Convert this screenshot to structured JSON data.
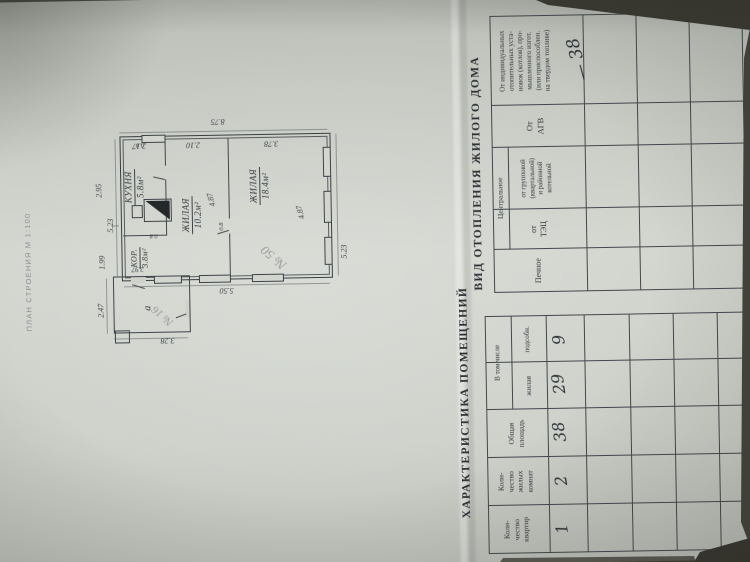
{
  "photo": {
    "page_color": "#cdd0c9",
    "background_color": "#46453d",
    "ink_color": "#373e42",
    "pencil_color": "#979e9e"
  },
  "plan": {
    "caption": "ПЛАН СТРОЕНИЯ  М 1:100",
    "rooms": {
      "kitchen": {
        "name": "КУХНЯ",
        "area": "5.8м²"
      },
      "corridor": {
        "name": "КОР.",
        "area": "3.8м²"
      },
      "living1": {
        "name": "ЖИЛАЯ",
        "area": "10.2м²"
      },
      "living2": {
        "name": "ЖИЛАЯ",
        "area": "18.4м²"
      }
    },
    "annex_letter": "а",
    "pencil_room_note": "№ 50",
    "pencil_annex_note": "№ 16",
    "dims": {
      "right_overall": "8.75",
      "right_kitchen": "2.17",
      "right_room1": "2.10",
      "right_room2": "3.78",
      "top_overall": "5.23",
      "top_left": "1.99",
      "top_right": "2.95",
      "bottom_overall": "5.23",
      "left_overall": "5.50",
      "room1_width": "4.87",
      "room2_width": "4.87",
      "annex_top": "2.47",
      "annex_left": "3.28",
      "annex_right": "2.97",
      "door_a": "0.8",
      "door_b": "0.8",
      "door_c": "0.8"
    }
  },
  "rooms_table": {
    "title": "ХАРАКТЕРИСТИКА ПОМЕЩЕНИЙ",
    "col_apartments": "Коли-\nчество\nквартир",
    "col_rooms": "Коли-\nчество\nжилых\nкомнат",
    "col_total_area": "Общая\nплощадь",
    "group_including": "В том числе",
    "col_living": "жилая",
    "col_auxiliary": "подсобн.",
    "row1": {
      "apartments": "1",
      "rooms": "2",
      "total_area": "38",
      "living": "29",
      "auxiliary": "9"
    }
  },
  "heating_table": {
    "title": "ВИД ОТОПЛЕНИЯ ЖИЛОГО ДОМА",
    "col_stove": "Печное",
    "group_central": "Центральное",
    "col_tets": "от\nТЭЦ",
    "col_district": "от групповой\n(квартальной)\nи районной\nкотельной",
    "col_agv": "От\nАГВ",
    "col_individual": "От индивидуальных\nотопительных уста-\nновок (котлов), про-\nмышленного изгот.\n(или приспособлен.\nна твердом топливе)",
    "row1_individual": "— 38"
  }
}
